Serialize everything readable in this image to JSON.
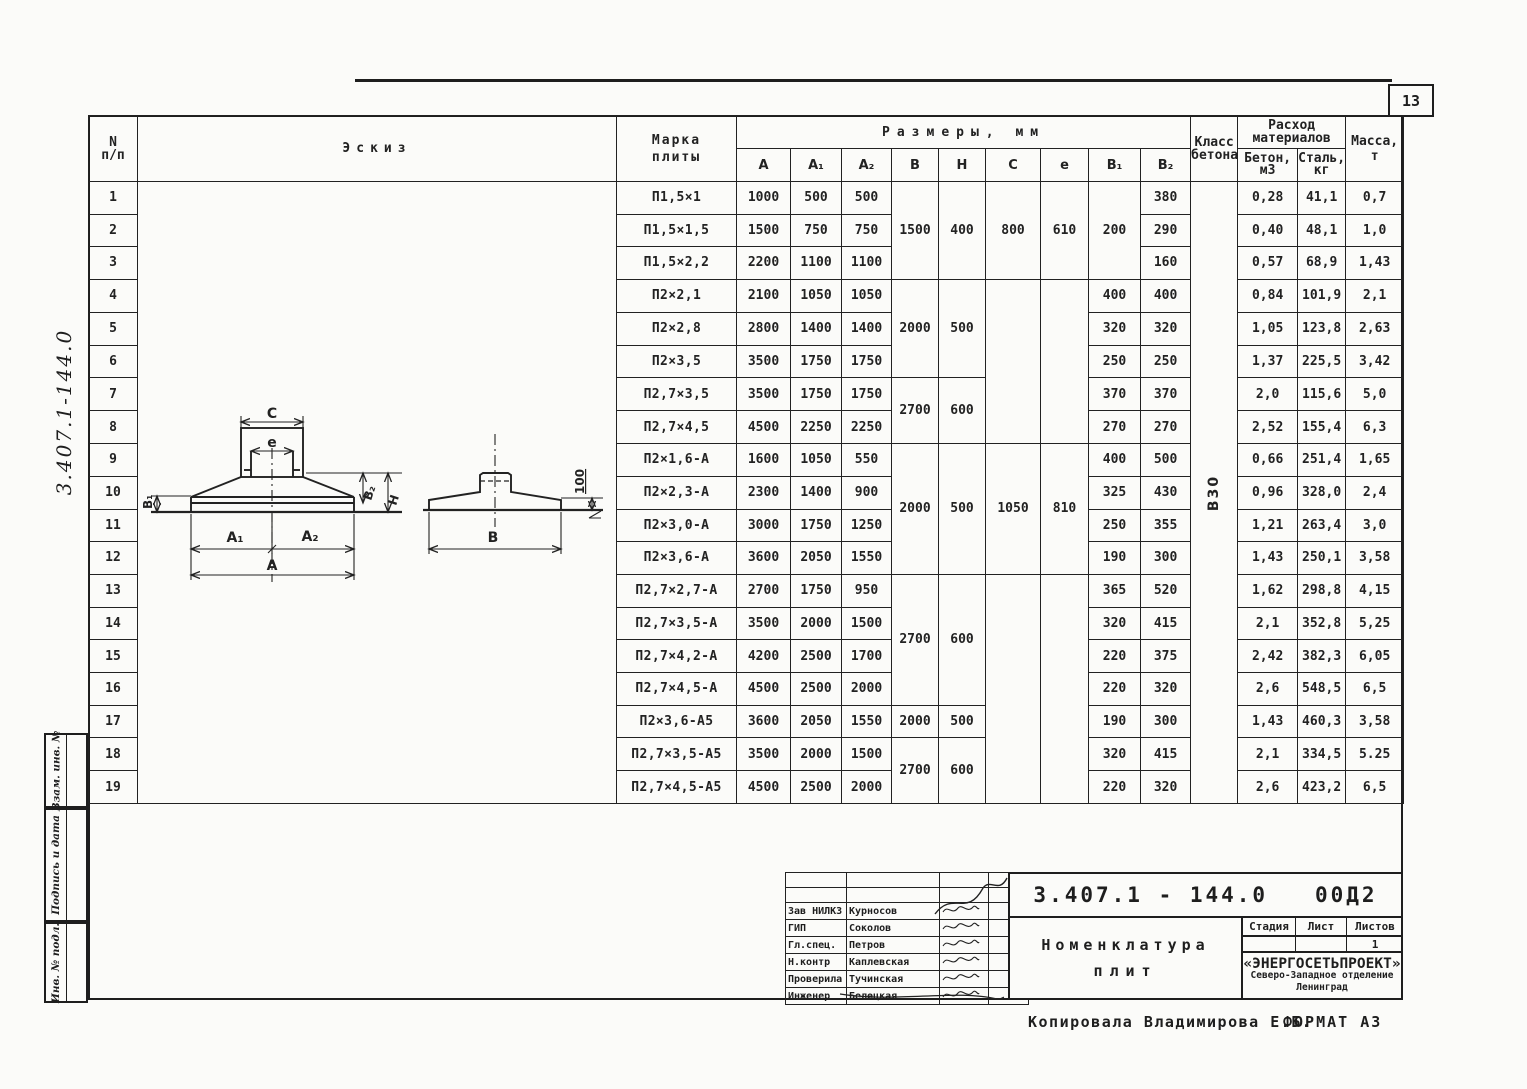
{
  "page": {
    "number": "13",
    "footer_copied": "Копировала  Владимирова Е.Б.",
    "footer_format": "ФОРМАТ А3",
    "side_doc_number": "3.407.1-144.0"
  },
  "side_stamp": {
    "labels": [
      "Взам. инв. №",
      "Подпись и дата",
      "Инв. № подл."
    ]
  },
  "table": {
    "header": {
      "num_line1": "N",
      "num_line2": "п/п",
      "sketch": "Эскиз",
      "mark_line1": "Марка",
      "mark_line2": "плиты",
      "sizes": "Размеры, мм",
      "class_line1": "Класс",
      "class_line2": "бетона",
      "materials_line1": "Расход",
      "materials_line2": "материалов",
      "concrete_line1": "Бетон,",
      "concrete_line2": "м3",
      "steel_line1": "Сталь,",
      "steel_line2": "кг",
      "mass_line1": "Масса,",
      "mass_line2": "т"
    },
    "size_columns": [
      "А",
      "А₁",
      "А₂",
      "В",
      "Н",
      "С",
      "е",
      "В₁",
      "В₂"
    ],
    "concrete_class": "В30",
    "rows": [
      {
        "num": "1",
        "mark": "П1,5×1",
        "A": "1000",
        "A1": "500",
        "A2": "500",
        "B1": null,
        "B2": "380",
        "concrete": "0,28",
        "steel": "41,1",
        "mass": "0,7"
      },
      {
        "num": "2",
        "mark": "П1,5×1,5",
        "A": "1500",
        "A1": "750",
        "A2": "750",
        "B1": null,
        "B2": "290",
        "concrete": "0,40",
        "steel": "48,1",
        "mass": "1,0"
      },
      {
        "num": "3",
        "mark": "П1,5×2,2",
        "A": "2200",
        "A1": "1100",
        "A2": "1100",
        "B1": null,
        "B2": "160",
        "concrete": "0,57",
        "steel": "68,9",
        "mass": "1,43"
      },
      {
        "num": "4",
        "mark": "П2×2,1",
        "A": "2100",
        "A1": "1050",
        "A2": "1050",
        "B1": "400",
        "B2": "400",
        "concrete": "0,84",
        "steel": "101,9",
        "mass": "2,1"
      },
      {
        "num": "5",
        "mark": "П2×2,8",
        "A": "2800",
        "A1": "1400",
        "A2": "1400",
        "B1": "320",
        "B2": "320",
        "concrete": "1,05",
        "steel": "123,8",
        "mass": "2,63"
      },
      {
        "num": "6",
        "mark": "П2×3,5",
        "A": "3500",
        "A1": "1750",
        "A2": "1750",
        "B1": "250",
        "B2": "250",
        "concrete": "1,37",
        "steel": "225,5",
        "mass": "3,42"
      },
      {
        "num": "7",
        "mark": "П2,7×3,5",
        "A": "3500",
        "A1": "1750",
        "A2": "1750",
        "B1": "370",
        "B2": "370",
        "concrete": "2,0",
        "steel": "115,6",
        "mass": "5,0"
      },
      {
        "num": "8",
        "mark": "П2,7×4,5",
        "A": "4500",
        "A1": "2250",
        "A2": "2250",
        "B1": "270",
        "B2": "270",
        "concrete": "2,52",
        "steel": "155,4",
        "mass": "6,3"
      },
      {
        "num": "9",
        "mark": "П2×1,6-А",
        "A": "1600",
        "A1": "1050",
        "A2": "550",
        "B1": "400",
        "B2": "500",
        "concrete": "0,66",
        "steel": "251,4",
        "mass": "1,65"
      },
      {
        "num": "10",
        "mark": "П2×2,3-А",
        "A": "2300",
        "A1": "1400",
        "A2": "900",
        "B1": "325",
        "B2": "430",
        "concrete": "0,96",
        "steel": "328,0",
        "mass": "2,4"
      },
      {
        "num": "11",
        "mark": "П2×3,0-А",
        "A": "3000",
        "A1": "1750",
        "A2": "1250",
        "B1": "250",
        "B2": "355",
        "concrete": "1,21",
        "steel": "263,4",
        "mass": "3,0"
      },
      {
        "num": "12",
        "mark": "П2×3,6-А",
        "A": "3600",
        "A1": "2050",
        "A2": "1550",
        "B1": "190",
        "B2": "300",
        "concrete": "1,43",
        "steel": "250,1",
        "mass": "3,58"
      },
      {
        "num": "13",
        "mark": "П2,7×2,7-А",
        "A": "2700",
        "A1": "1750",
        "A2": "950",
        "B1": "365",
        "B2": "520",
        "concrete": "1,62",
        "steel": "298,8",
        "mass": "4,15"
      },
      {
        "num": "14",
        "mark": "П2,7×3,5-А",
        "A": "3500",
        "A1": "2000",
        "A2": "1500",
        "B1": "320",
        "B2": "415",
        "concrete": "2,1",
        "steel": "352,8",
        "mass": "5,25"
      },
      {
        "num": "15",
        "mark": "П2,7×4,2-А",
        "A": "4200",
        "A1": "2500",
        "A2": "1700",
        "B1": "220",
        "B2": "375",
        "concrete": "2,42",
        "steel": "382,3",
        "mass": "6,05"
      },
      {
        "num": "16",
        "mark": "П2,7×4,5-А",
        "A": "4500",
        "A1": "2500",
        "A2": "2000",
        "B1": "220",
        "B2": "320",
        "concrete": "2,6",
        "steel": "548,5",
        "mass": "6,5"
      },
      {
        "num": "17",
        "mark": "П2×3,6-А5",
        "A": "3600",
        "A1": "2050",
        "A2": "1550",
        "B1": "190",
        "B2": "300",
        "concrete": "1,43",
        "steel": "460,3",
        "mass": "3,58"
      },
      {
        "num": "18",
        "mark": "П2,7×3,5-А5",
        "A": "3500",
        "A1": "2000",
        "A2": "1500",
        "B1": "320",
        "B2": "415",
        "concrete": "2,1",
        "steel": "334,5",
        "mass": "5.25"
      },
      {
        "num": "19",
        "mark": "П2,7×4,5-А5",
        "A": "4500",
        "A1": "2500",
        "A2": "2000",
        "B1": "220",
        "B2": "320",
        "concrete": "2,6",
        "steel": "423,2",
        "mass": "6,5"
      }
    ],
    "bh_groups": [
      {
        "start": 1,
        "span": 3,
        "B": "1500",
        "H": "400"
      },
      {
        "start": 4,
        "span": 3,
        "B": "2000",
        "H": "500"
      },
      {
        "start": 7,
        "span": 2,
        "B": "2700",
        "H": "600"
      },
      {
        "start": 9,
        "span": 4,
        "B": "2000",
        "H": "500"
      },
      {
        "start": 13,
        "span": 4,
        "B": "2700",
        "H": "600"
      },
      {
        "start": 17,
        "span": 1,
        "B": "2000",
        "H": "500"
      },
      {
        "start": 18,
        "span": 2,
        "B": "2700",
        "H": "600"
      }
    ],
    "ce_groups": [
      {
        "start": 1,
        "span": 3,
        "C": "800",
        "e": "610"
      },
      {
        "start": 4,
        "span": 5,
        "C": "",
        "e": ""
      },
      {
        "start": 9,
        "span": 4,
        "C": "1050",
        "e": "810"
      },
      {
        "start": 13,
        "span": 7,
        "C": "",
        "e": ""
      }
    ],
    "b1_groups": [
      {
        "start": 1,
        "span": 3,
        "v": "200"
      }
    ]
  },
  "sketch": {
    "labels": {
      "C": "С",
      "e": "е",
      "B1": "В₁",
      "B2": "В₂",
      "H": "Н",
      "A1": "А₁",
      "A2": "А₂",
      "A": "А",
      "B": "В",
      "offset": "100"
    }
  },
  "title_block": {
    "doc_number": "3.407.1 - 144.0   00Д2",
    "signatures": [
      {
        "role": "Зав НИЛКЗ",
        "name": "Курносов"
      },
      {
        "role": "ГИП",
        "name": "Соколов"
      },
      {
        "role": "Гл.спец.",
        "name": "Петров"
      },
      {
        "role": "Н.контр",
        "name": "Каплевская"
      },
      {
        "role": "Проверила",
        "name": "Тучинская"
      },
      {
        "role": "Инженер",
        "name": "Белецкая"
      }
    ],
    "title_line1": "Номенклатура",
    "title_line2": "плит",
    "stage_cols": [
      "Стадия",
      "Лист",
      "Листов"
    ],
    "sheets_value": "1",
    "org_name": "«ЭНЕРГОСЕТЬПРОЕКТ»",
    "org_branch": "Северо-Западное отделение",
    "org_city": "Ленинград"
  }
}
